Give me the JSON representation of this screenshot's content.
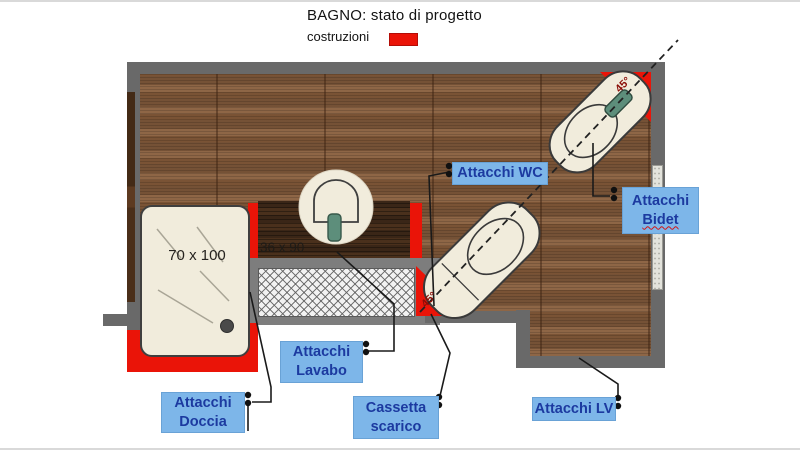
{
  "header": {
    "title": "BAGNO: stato di progetto",
    "legend_label": "costruzioni",
    "legend_color": "#ea1408"
  },
  "plan": {
    "shower_dimension": "70 x 100",
    "counter_dimension": "36 x 90",
    "wc_angle": "45°",
    "bidet_angle": "45°",
    "labels": {
      "wc": {
        "line1": "Attacchi WC"
      },
      "bidet": {
        "line1": "Attacchi",
        "line2": "Bidet"
      },
      "lavabo": {
        "line1": "Attacchi",
        "line2": "Lavabo"
      },
      "doccia": {
        "line1": "Attacchi",
        "line2": "Doccia"
      },
      "cassetta": {
        "line1": "Cassetta",
        "line2": "scarico"
      },
      "lv": {
        "line1": "Attacchi LV"
      }
    },
    "colors": {
      "construction_red": "#ea1408",
      "wall_gray": "#696969",
      "floor_wood": "#8e6646",
      "counter_wood": "#3a2617",
      "fixture_cream": "#f1ecdc",
      "label_background_blue": "#7db6e9",
      "label_text_blue": "#1c3aa0",
      "faucet_green": "#5d8e7b",
      "angle_text_red": "#8b0e08"
    }
  }
}
